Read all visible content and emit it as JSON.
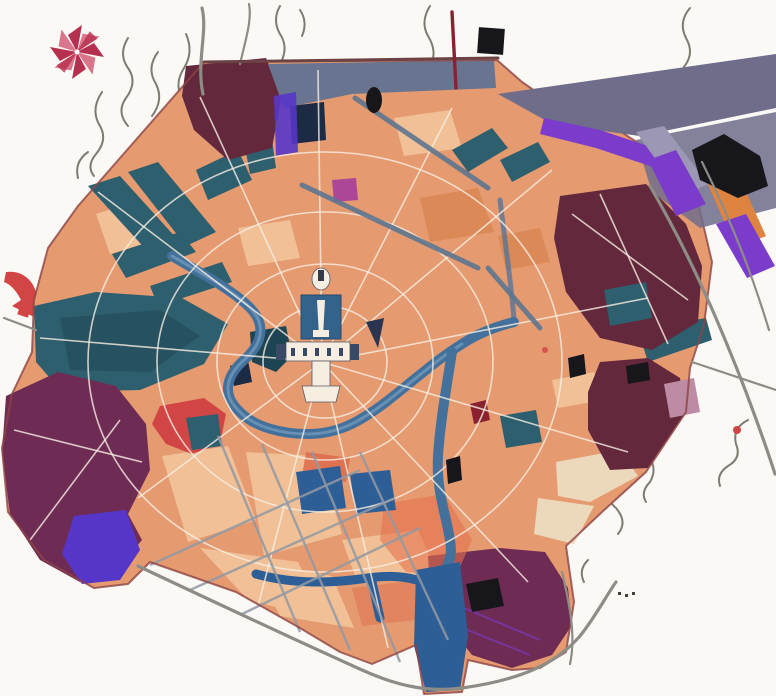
{
  "meta": {
    "kind": "scanned-city-master-plan-map",
    "visible_text": "none (no legible labels in the image)",
    "canvas": {
      "width": 776,
      "height": 696
    }
  },
  "icons": {
    "compass_rose": "eight-petal pinwheel star, crimson",
    "flow_arrow": "curved red arrow at left edge"
  },
  "legend_visual": [
    {
      "name": "urban-fabric-blocks",
      "palette_key": "salmon"
    },
    {
      "name": "light-urban-blocks",
      "palette_key": "salmonLight"
    },
    {
      "name": "green-park-wedges",
      "palette_key": "teal"
    },
    {
      "name": "river-and-canals",
      "palette_key": "riverBlue"
    },
    {
      "name": "dark-outer-districts",
      "palette_key": "maroonPurple"
    },
    {
      "name": "bright-purple-strips",
      "palette_key": "purple"
    },
    {
      "name": "slate-band-top-right",
      "palette_key": "slateBand"
    },
    {
      "name": "black-patches",
      "palette_key": "black"
    },
    {
      "name": "off-map-streams",
      "palette_key": "streamGray"
    },
    {
      "name": "off-map-roads",
      "palette_key": "roadGray"
    }
  ],
  "colors": {
    "paper": "#fbf9f6",
    "salmon": "#e59a70",
    "salmonLight": "#f1c096",
    "salmonDark": "#d8814f",
    "cream": "#ecd9bc",
    "orangeRed": "#dd6a4a",
    "orangeGlow": "#e4734e",
    "orangeStrip": "#df8440",
    "red": "#d24545",
    "crimson": "#b5304e",
    "crimsonLight": "#d9768c",
    "magenta": "#ac4798",
    "pinkPatch": "#bd8ba3",
    "maroonBrown": "#63283c",
    "maroonPurple": "#6e2c55",
    "purple": "#7b3ccc",
    "indigo": "#5636c9",
    "lavender": "#9c97b5",
    "slateBand": "#6f6d89",
    "slateBlue": "#697590",
    "teal": "#2e5f6e",
    "tealDark": "#1d4452",
    "navy": "#2e5e96",
    "navyDark": "#1d2a44",
    "riverBlue": "#43719c",
    "riverLight": "#85aac6",
    "black": "#17161a",
    "roadGray": "#8e8c86",
    "streamGray": "#7e7c72",
    "streetWhite": "#f7eee2",
    "streetGray": "#9199a3",
    "streetBlueGray": "#5d7590",
    "boundaryRed": "#8d4343",
    "darkRoad": "#6b4344",
    "darkRed": "#8a2130"
  }
}
